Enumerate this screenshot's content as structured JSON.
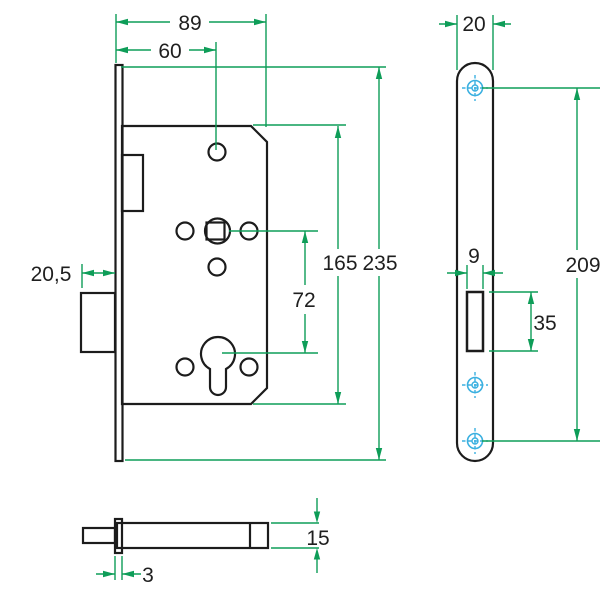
{
  "drawing": {
    "type": "technical-drawing",
    "subject": "mortise-lock",
    "colors": {
      "outline": "#1c1c1c",
      "dimension_lines": "#0e9d58",
      "screw_hole_marks": "#3bb0e0",
      "background": "#ffffff"
    }
  },
  "dimensions": {
    "front_view": {
      "case_width": "89",
      "backset": "60",
      "deadbolt_throw": "20,5",
      "follower_to_cylinder": "72",
      "case_height": "165",
      "faceplate_height": "235"
    },
    "faceplate_view": {
      "faceplate_width": "20",
      "latch_cutout_width": "9",
      "latch_cutout_height": "35",
      "screw_spacing": "209"
    },
    "side_view": {
      "bolt_height": "15",
      "faceplate_thickness": "3"
    }
  }
}
